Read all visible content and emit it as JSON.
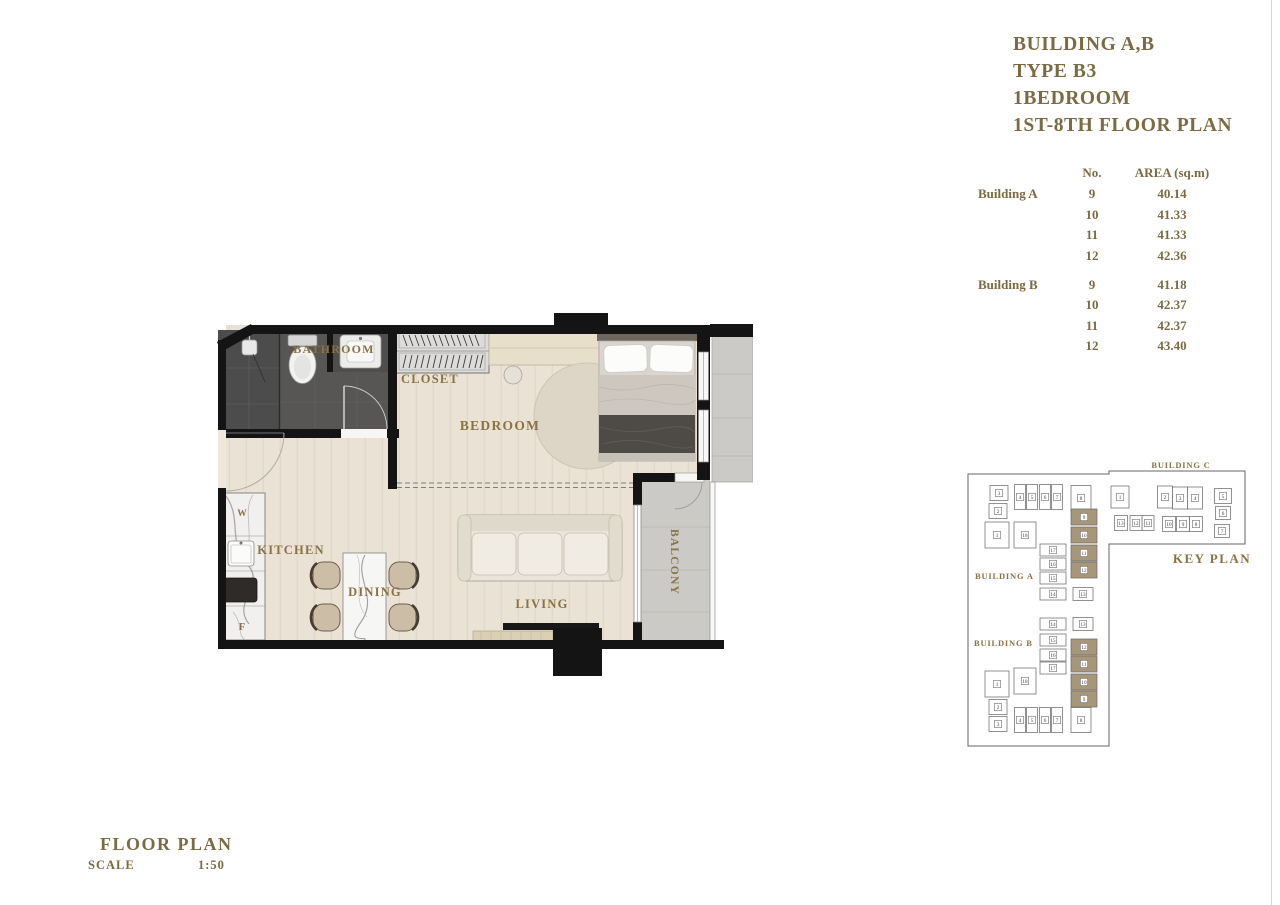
{
  "title_block": {
    "lines": [
      "BUILDING A,B",
      "TYPE B3",
      "1BEDROOM",
      "1ST-8TH FLOOR PLAN"
    ]
  },
  "area_table": {
    "headers": {
      "no": "No.",
      "area": "AREA (sq.m)"
    },
    "groups": [
      {
        "name": "Building A",
        "rows": [
          {
            "no": "9",
            "area": "40.14"
          },
          {
            "no": "10",
            "area": "41.33"
          },
          {
            "no": "11",
            "area": "41.33"
          },
          {
            "no": "12",
            "area": "42.36"
          }
        ]
      },
      {
        "name": "Building B",
        "rows": [
          {
            "no": "9",
            "area": "41.18"
          },
          {
            "no": "10",
            "area": "42.37"
          },
          {
            "no": "11",
            "area": "42.37"
          },
          {
            "no": "12",
            "area": "43.40"
          }
        ]
      }
    ]
  },
  "floor_plan": {
    "rooms": {
      "bathroom": "BATHROOM",
      "closet": "CLOSET",
      "bedroom": "BEDROOM",
      "kitchen": "KITCHEN",
      "dining": "DINING",
      "living": "LIVING",
      "balcony": "BALCONY"
    },
    "appliance_labels": {
      "fridge": "F",
      "washer": "W"
    }
  },
  "key_plan": {
    "title": "KEY PLAN",
    "buildings": [
      {
        "name": "BUILDING A",
        "units": [
          "1",
          "2",
          "3",
          "4",
          "5",
          "6",
          "7",
          "8",
          "9",
          "10",
          "11",
          "12",
          "13",
          "14",
          "15",
          "16",
          "17",
          "18"
        ],
        "highlighted_units": [
          "9",
          "10",
          "11",
          "12"
        ]
      },
      {
        "name": "BUILDING B",
        "units": [
          "1",
          "2",
          "3",
          "4",
          "5",
          "6",
          "7",
          "8",
          "9",
          "10",
          "11",
          "12",
          "13",
          "14",
          "15",
          "16",
          "17",
          "18"
        ],
        "highlighted_units": [
          "9",
          "10",
          "11",
          "12"
        ]
      },
      {
        "name": "BUILDING C",
        "units": [
          "1",
          "2",
          "3",
          "4",
          "5",
          "6",
          "7",
          "8",
          "9",
          "10",
          "11",
          "12",
          "13"
        ],
        "highlighted_units": []
      }
    ]
  },
  "footer": {
    "label": "FLOOR PLAN",
    "scale_label": "SCALE",
    "scale_value": "1:50"
  },
  "colors": {
    "accent_text": "#7b6a42",
    "plan_label": "#8a7243",
    "wall": "#141414",
    "floor": "#eae2d4",
    "bathroom_floor": "#575654",
    "balcony_floor": "#cbcac6",
    "key_plan_highlight": "#a79678"
  }
}
